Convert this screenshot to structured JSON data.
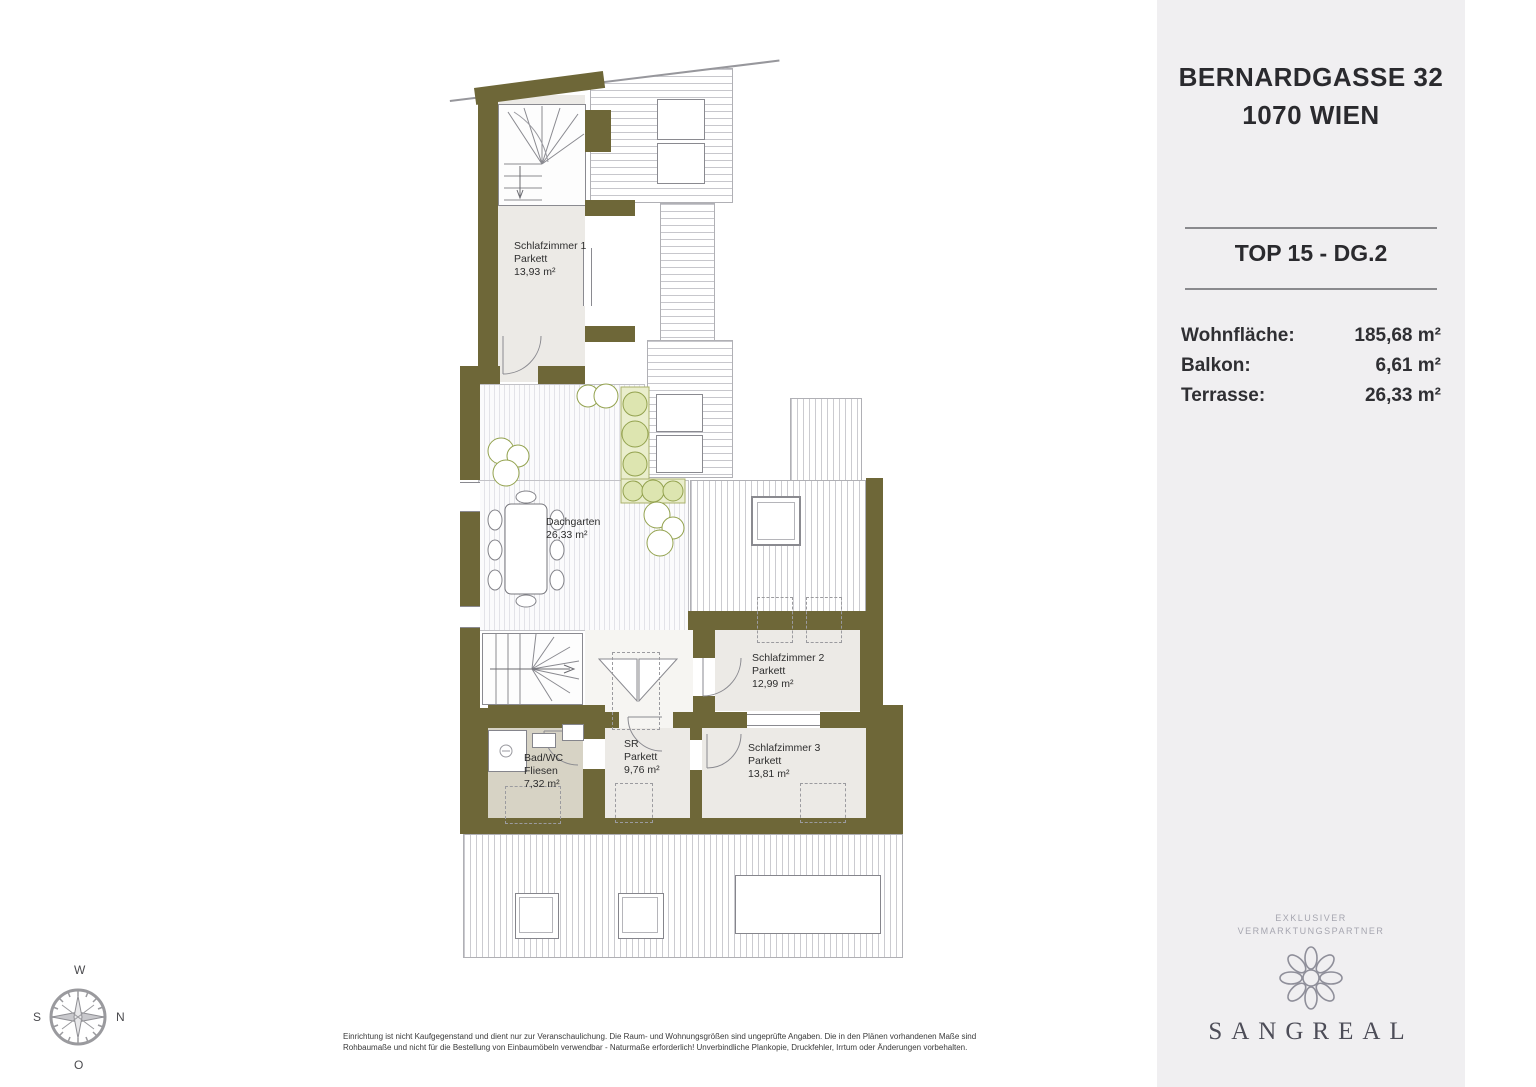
{
  "panel": {
    "address_line1": "BERNARDGASSE 32",
    "address_line2": "1070 WIEN",
    "unit": "TOP 15 - DG.2",
    "areas": [
      {
        "label": "Wohnfläche:",
        "value": "185,68 m²"
      },
      {
        "label": "Balkon:",
        "value": "6,61 m²"
      },
      {
        "label": "Terrasse:",
        "value": "26,33 m²"
      }
    ],
    "partner_tagline_line1": "EXKLUSIVER",
    "partner_tagline_line2": "VERMARKTUNGSPARTNER",
    "brand": "SANGREAL"
  },
  "plan": {
    "rooms": [
      {
        "name": "Schlafzimmer 1",
        "floor": "Parkett",
        "area": "13,93 m²"
      },
      {
        "name": "Dachgarten",
        "floor": "",
        "area": "26,33 m²"
      },
      {
        "name": "Schlafzimmer 2",
        "floor": "Parkett",
        "area": "12,99 m²"
      },
      {
        "name": "SR",
        "floor": "Parkett",
        "area": "9,76 m²"
      },
      {
        "name": "Schlafzimmer 3",
        "floor": "Parkett",
        "area": "13,81 m²"
      },
      {
        "name": "Bad/WC",
        "floor": "Fliesen",
        "area": "7,32 m²"
      }
    ],
    "colors": {
      "wall": "#6e6738",
      "room": "#eceae6",
      "bath": "#d7d3c5",
      "panel_bg": "#f0eff1"
    }
  },
  "compass": {
    "top": "W",
    "right": "N",
    "left": "S",
    "bottom": "O"
  },
  "disclaimer": {
    "line1": "Einrichtung ist nicht Kaufgegenstand und dient nur zur Veranschaulichung. Die Raum- und Wohnungsgrößen sind ungeprüfte Angaben. Die in den Plänen vorhandenen Maße sind",
    "line2": "Rohbaumaße und nicht für die Bestellung von Einbaumöbeln verwendbar - Naturmaße erforderlich! Unverbindliche Plankopie, Druckfehler, Irrtum oder Änderungen vorbehalten."
  }
}
